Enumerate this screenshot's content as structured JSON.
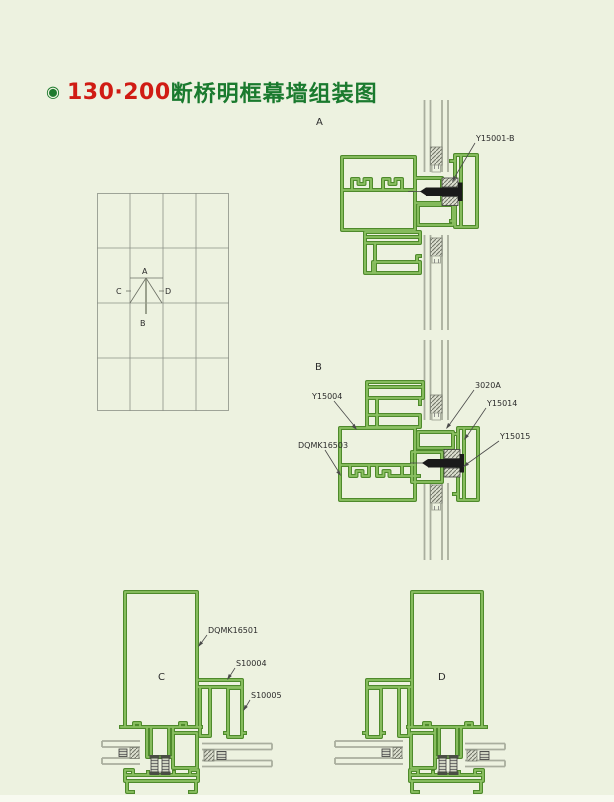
{
  "title": {
    "bullet_icon": "◉",
    "code": "130·200",
    "name": "断桥明框幕墙组装图"
  },
  "colors": {
    "background": "#edf2e0",
    "profile_green_dark": "#4e8a2b",
    "profile_green_light": "#8cc163",
    "title_red": "#d01c14",
    "title_green": "#1a7a2e",
    "glass_gray": "#a9ae9e",
    "bolt_black": "#1a1a1a",
    "label_text": "#2b2b2b"
  },
  "elevation_grid": {
    "columns": 4,
    "rows": 4,
    "marker": {
      "top": "A",
      "bottom": "B",
      "left": "C",
      "right": "D"
    }
  },
  "detail_a": {
    "letter": "A",
    "labels": {
      "bolt_part": "Y15001-B"
    }
  },
  "detail_b": {
    "letter": "B",
    "labels": {
      "top_profile": "Y15004",
      "mullion": "DQMK16503",
      "insert": "3020A",
      "cover": "Y15014",
      "bolt_part": "Y15015"
    }
  },
  "section_c": {
    "letter": "C",
    "labels": {
      "mullion": "DQMK16501",
      "adapter": "S10004",
      "bead": "S10005"
    }
  },
  "section_d": {
    "letter": "D"
  }
}
